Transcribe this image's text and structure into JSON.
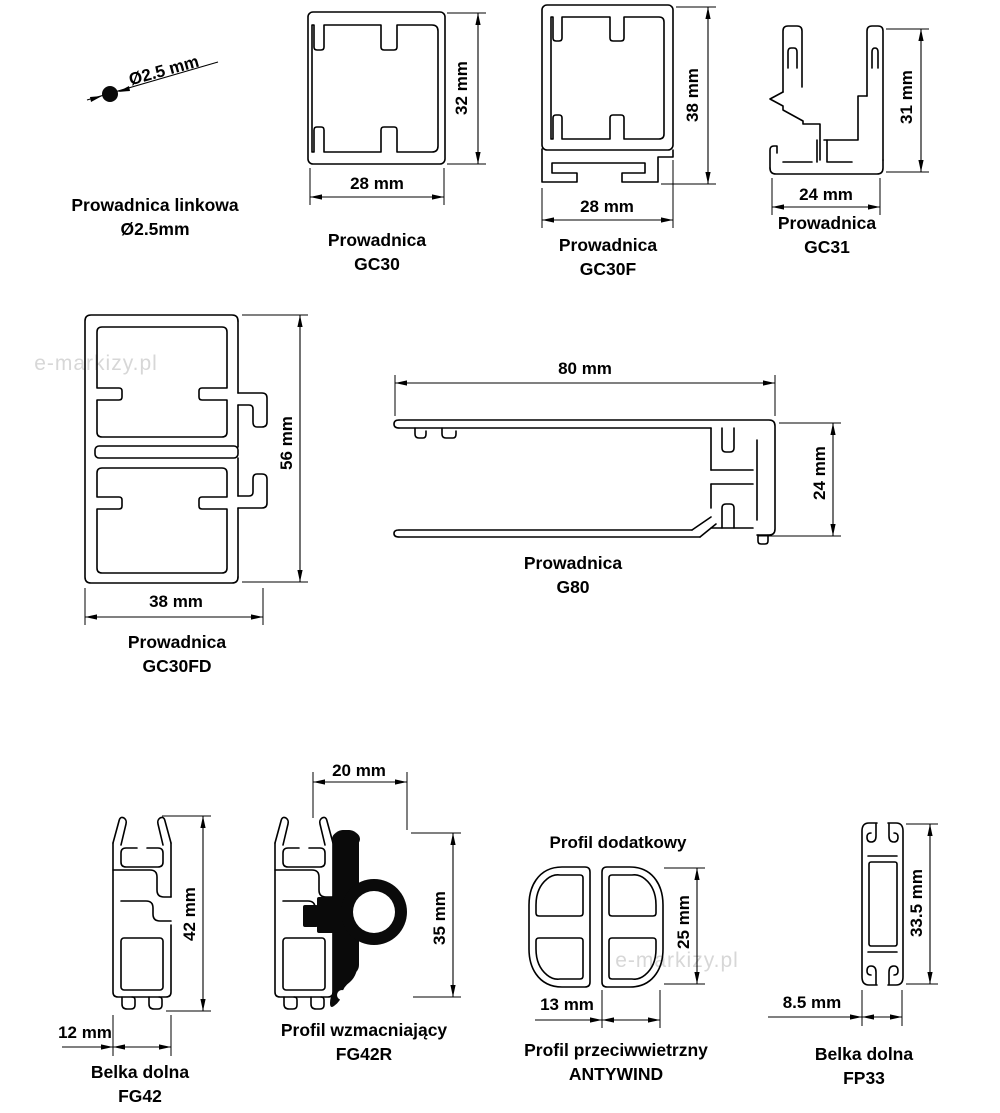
{
  "page": {
    "background": "#ffffff",
    "line_color": "#000000",
    "watermark_color": "#d7d7d7"
  },
  "watermarks": [
    {
      "text": "e-markizy.pl"
    },
    {
      "text": "e-markizy.pl"
    }
  ],
  "profiles": [
    {
      "name": "prowadnica-linkowa",
      "caption": [
        "Prowadnica linkowa",
        "Ø2.5mm"
      ],
      "diameter_label": "Ø2.5 mm"
    },
    {
      "name": "gc30",
      "caption": [
        "Prowadnica",
        "GC30"
      ],
      "width_label": "28 mm",
      "height_label": "32 mm"
    },
    {
      "name": "gc30f",
      "caption": [
        "Prowadnica",
        "GC30F"
      ],
      "width_label": "28 mm",
      "height_label": "38 mm"
    },
    {
      "name": "gc31",
      "caption": [
        "Prowadnica",
        "GC31"
      ],
      "width_label": "24 mm",
      "height_label": "31 mm"
    },
    {
      "name": "gc30fd",
      "caption": [
        "Prowadnica",
        "GC30FD"
      ],
      "width_label": "38 mm",
      "height_label": "56 mm"
    },
    {
      "name": "g80",
      "caption": [
        "Prowadnica",
        "G80"
      ],
      "width_label": "80 mm",
      "height_label": "24 mm"
    },
    {
      "name": "fg42",
      "caption": [
        "Belka dolna",
        "FG42"
      ],
      "width_label": "12 mm",
      "height_label": "42 mm"
    },
    {
      "name": "fg42r",
      "caption": [
        "Profil wzmacniający",
        "FG42R"
      ],
      "width_label": "20 mm",
      "height_label": "35 mm"
    },
    {
      "name": "antywind",
      "caption": [
        "Profil przeciwwietrzny",
        "ANTYWIND"
      ],
      "header": "Profil dodatkowy",
      "width_label": "13 mm",
      "height_label": "25 mm"
    },
    {
      "name": "fp33",
      "caption": [
        "Belka dolna",
        "FP33"
      ],
      "width_label": "8.5 mm",
      "height_label": "33.5 mm"
    }
  ]
}
